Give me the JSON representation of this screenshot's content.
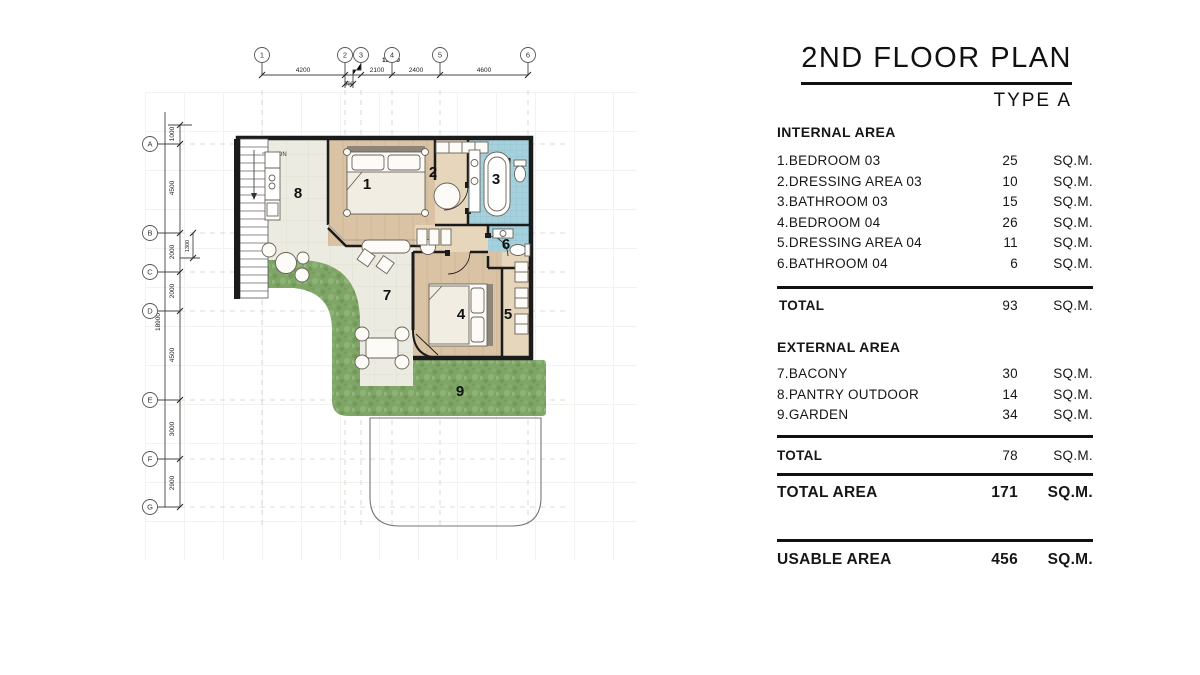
{
  "header": {
    "title": "2ND FLOOR PLAN",
    "subtitle": "TYPE A"
  },
  "internal": {
    "heading": "INTERNAL AREA",
    "rows": [
      {
        "label": "1.BEDROOM 03",
        "value": "25",
        "unit": "SQ.M."
      },
      {
        "label": "2.DRESSING AREA 03",
        "value": "10",
        "unit": "SQ.M."
      },
      {
        "label": "3.BATHROOM 03",
        "value": "15",
        "unit": "SQ.M."
      },
      {
        "label": "4.BEDROOM 04",
        "value": "26",
        "unit": "SQ.M."
      },
      {
        "label": "5.DRESSING AREA 04",
        "value": "11",
        "unit": "SQ.M."
      },
      {
        "label": "6.BATHROOM 04",
        "value": "6",
        "unit": "SQ.M."
      }
    ],
    "total": {
      "label": "TOTAL",
      "value": "93",
      "unit": "SQ.M."
    }
  },
  "external": {
    "heading": "EXTERNAL AREA",
    "rows": [
      {
        "label": "7.BACONY",
        "value": "30",
        "unit": "SQ.M."
      },
      {
        "label": "8.PANTRY OUTDOOR",
        "value": "14",
        "unit": "SQ.M."
      },
      {
        "label": "9.GARDEN",
        "value": "34",
        "unit": "SQ.M."
      }
    ],
    "total": {
      "label": "TOTAL",
      "value": "78",
      "unit": "SQ.M."
    }
  },
  "total_area": {
    "label": "TOTAL AREA",
    "value": "171",
    "unit": "SQ.M."
  },
  "usable_area": {
    "label": "USABLE AREA",
    "value": "456",
    "unit": "SQ.M."
  },
  "plan": {
    "rooms": [
      {
        "number": "1",
        "name": "bedroom-03"
      },
      {
        "number": "2",
        "name": "dressing-area-03"
      },
      {
        "number": "3",
        "name": "bathroom-03"
      },
      {
        "number": "4",
        "name": "bedroom-04"
      },
      {
        "number": "5",
        "name": "dressing-area-04"
      },
      {
        "number": "6",
        "name": "bathroom-04"
      },
      {
        "number": "7",
        "name": "balcony"
      },
      {
        "number": "8",
        "name": "pantry-outdoor"
      },
      {
        "number": "9",
        "name": "garden"
      }
    ],
    "grid": {
      "cols": [
        "1",
        "2",
        "3",
        "4",
        "5",
        "6"
      ],
      "col_dims": [
        "4200",
        "300",
        "2100",
        "2400",
        "4600"
      ],
      "col_total": "13600",
      "rows": [
        "A",
        "B",
        "C",
        "D",
        "E",
        "F",
        "G"
      ],
      "row_dims": [
        "1000",
        "4500",
        "2000",
        "2000",
        "4500",
        "3000",
        "2900"
      ],
      "row_total": "18900",
      "row_sub_dim": "1300"
    },
    "stair_label": "DN",
    "colors": {
      "wood": "#d9c3a4",
      "wood_light": "#e6d6bc",
      "tile_blue": "#a6d1dc",
      "outdoor": "#ecebe1",
      "garden": "#7fa567",
      "wall": "#1b1b1b"
    }
  }
}
